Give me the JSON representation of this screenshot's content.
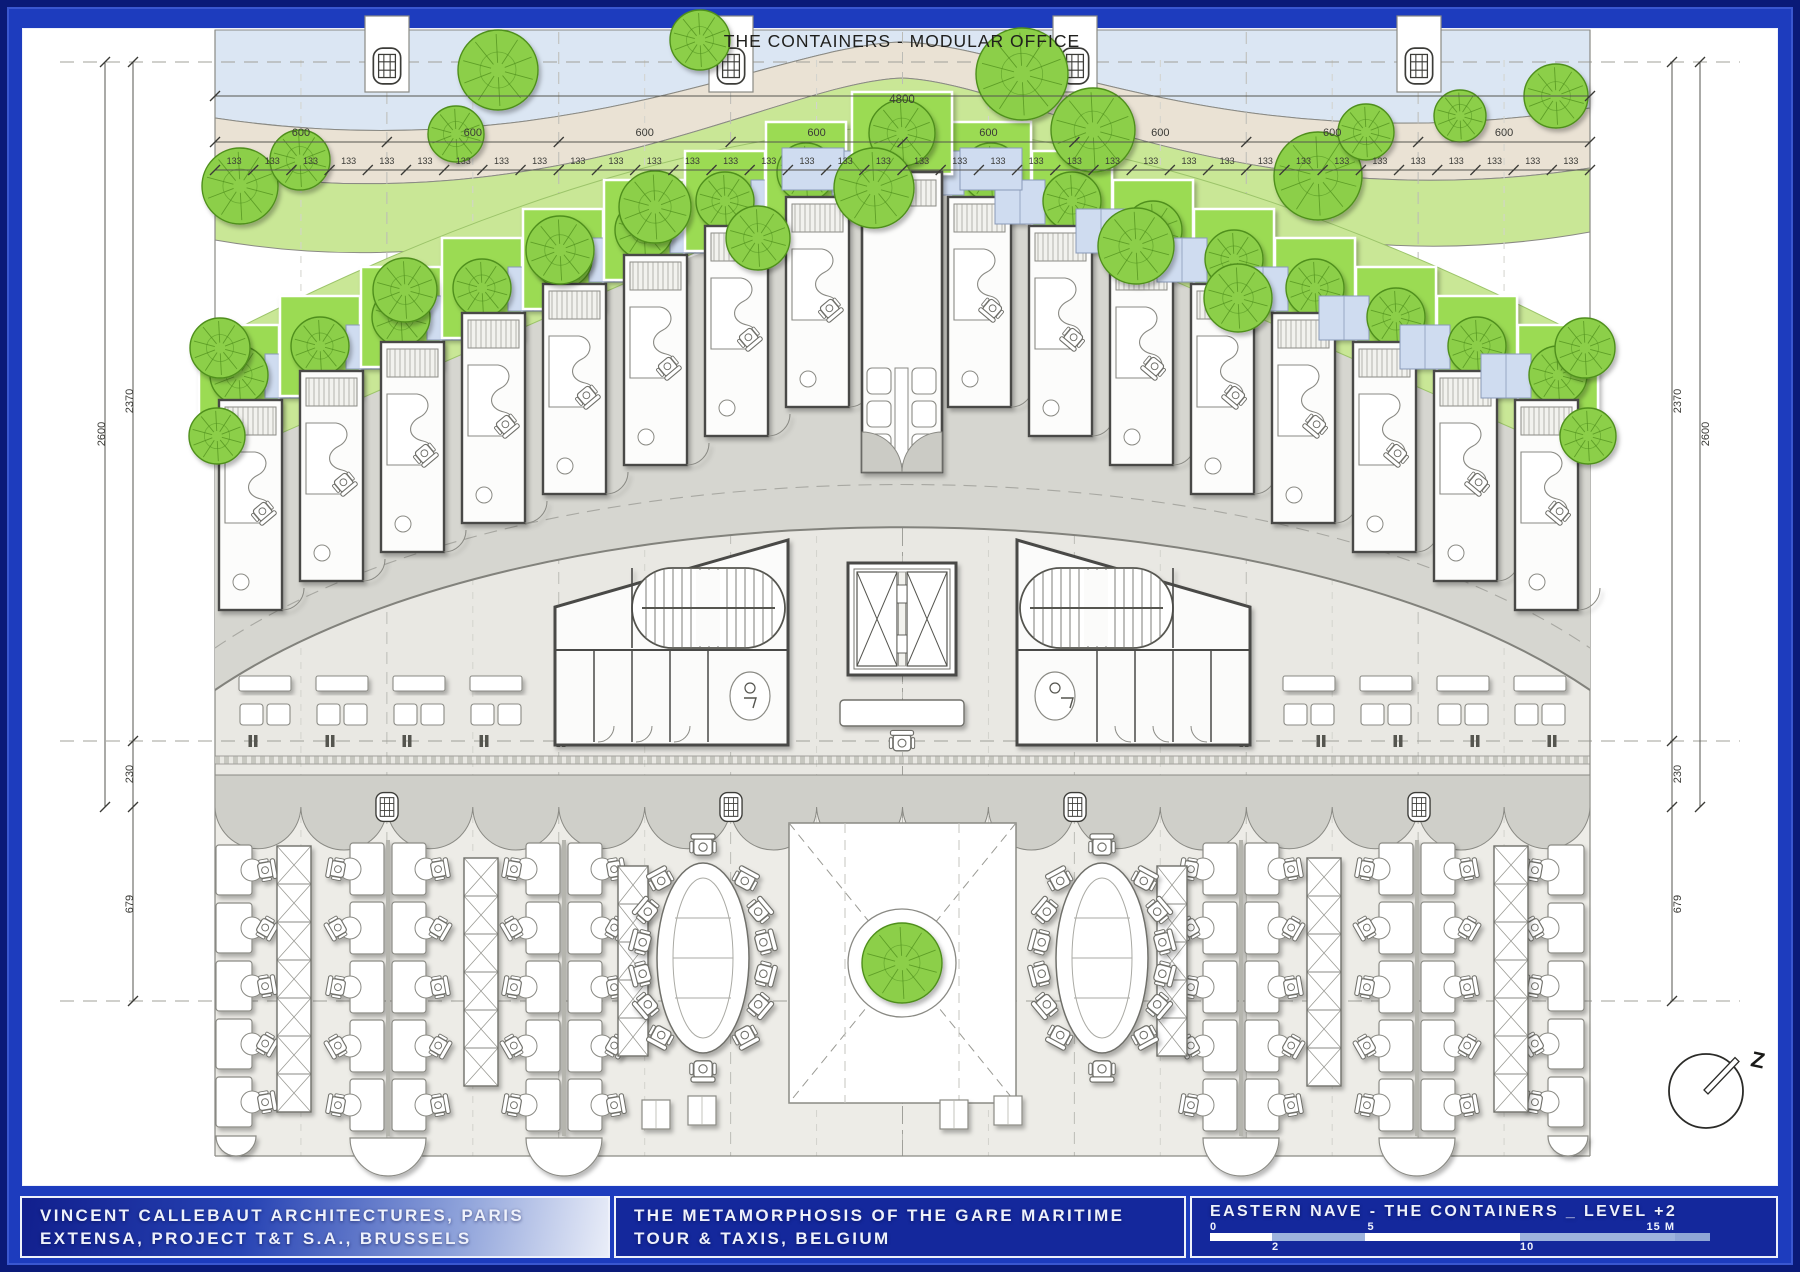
{
  "plan": {
    "title": "THE CONTAINERS - MODULAR OFFICE",
    "north_label": "Z",
    "dimensions": {
      "overall": "4800",
      "bay": {
        "label": "600",
        "count": 8
      },
      "module": {
        "label": "133",
        "count": 36
      },
      "left": {
        "outer": "2600",
        "upper": "2370",
        "middle": "230",
        "lower": "679"
      },
      "right": {
        "outer": "2600",
        "upper": "2370",
        "middle": "230",
        "lower": "679"
      }
    }
  },
  "titleblock": {
    "architect_line1": "VINCENT CALLEBAUT ARCHITECTURES, PARIS",
    "architect_line2": "EXTENSA, PROJECT T&T S.A., BRUSSELS",
    "project_line1": "THE METAMORPHOSIS OF THE GARE MARITIME",
    "project_line2": "TOUR & TAXIS, BELGIUM",
    "sheet_title": "EASTERN NAVE - THE CONTAINERS _ LEVEL +2",
    "scalebar": {
      "top_labels": [
        "0",
        "5",
        "15 M"
      ],
      "bottom_labels": [
        "2",
        "10"
      ],
      "segments": [
        2,
        3,
        5,
        5
      ]
    }
  },
  "colors": {
    "frame_blue": "#1d3cbe",
    "panel_blue": "#14289c",
    "scale_light": "#9db3dd",
    "water": "#dbe6f3",
    "path_beige": "#eae2d4",
    "lawn": "#c9e796",
    "roof_green": "#9bdb52",
    "tree_fill": "#8ccf49",
    "tree_stroke": "#4f8f1d",
    "canopy_gray": "#d6d6d0",
    "floor_gray": "#e9e8e3",
    "office_floor": "#edece7",
    "scallop_gray": "#cfcfc9",
    "wall": "#4a4a46",
    "line": "#8a8a84",
    "dim": "#3a3a36"
  }
}
